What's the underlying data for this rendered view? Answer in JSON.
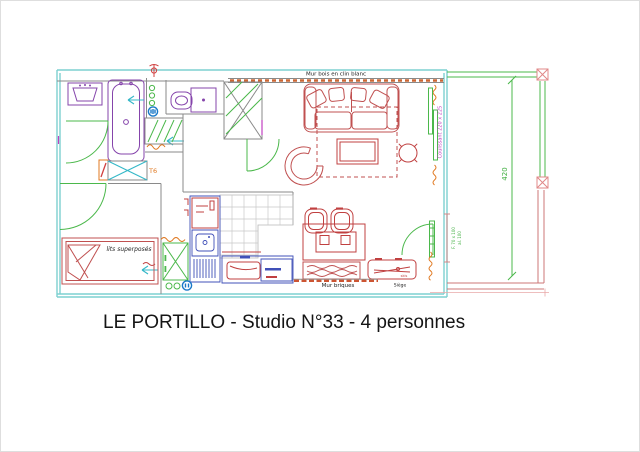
{
  "title": "LE PORTILLO - Studio N°33 - 4 personnes",
  "plan": {
    "walls": {
      "top_label": "Mur bois en clin blanc",
      "bottom_label": "Mur briques"
    },
    "rooms": {
      "bunk_bed_label": "lits superposés",
      "unit_label": "T6"
    },
    "furniture": {
      "seat_label": "Siège",
      "skis_label": "skis"
    },
    "annotations": {
      "sliding_door": "Coulissant 220 x 225",
      "balcony_dimension": "420",
      "window_size": "F. 70 x 100",
      "window_sill": "al. 100"
    },
    "colors": {
      "exterior_wall_cyan": "#7dd0d0",
      "door_green": "#4bb84b",
      "furniture_red": "#c05050",
      "sanitary_purple": "#8544ab",
      "kitchen_blue": "#4050b8",
      "hatch_orange": "#e07820",
      "annotation_magenta": "#c040c0",
      "dimension_green": "#3fae3f",
      "balcony_post_red": "#e08888",
      "text_black": "#1a1a1a"
    }
  }
}
